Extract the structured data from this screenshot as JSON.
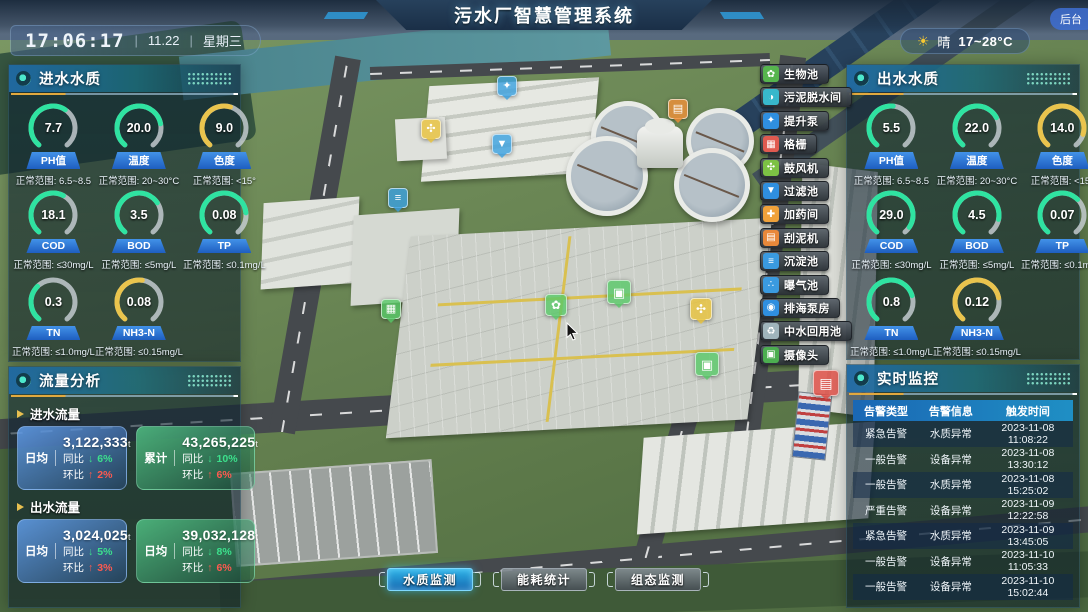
{
  "header": {
    "title": "污水厂智慧管理系统",
    "time": "17:06:17",
    "date": "11.22",
    "weekday": "星期三",
    "separator": "|",
    "weather": {
      "condition": "晴",
      "temp_range": "17~28°C"
    },
    "backstage_label": "后台"
  },
  "inlet_quality": {
    "title": "进水水质",
    "gauges": [
      {
        "label": "PH值",
        "value": "7.7",
        "range": "正常范围: 6.5~8.5",
        "color": "#2fe3a1",
        "percent": 62
      },
      {
        "label": "温度",
        "value": "20.0",
        "range": "正常范围: 20~30°C",
        "color": "#2fe3a1",
        "percent": 78
      },
      {
        "label": "色度",
        "value": "9.0",
        "range": "正常范围: <15°",
        "color": "#eac44d",
        "percent": 56
      },
      {
        "label": "COD",
        "value": "18.1",
        "range": "正常范围: ≤30mg/L",
        "color": "#2fe3a1",
        "percent": 60
      },
      {
        "label": "BOD",
        "value": "3.5",
        "range": "正常范围: ≤5mg/L",
        "color": "#2fe3a1",
        "percent": 70
      },
      {
        "label": "TP",
        "value": "0.08",
        "range": "正常范围: ≤0.1mg/L",
        "color": "#2fe3a1",
        "percent": 80
      },
      {
        "label": "TN",
        "value": "0.3",
        "range": "正常范围: ≤1.0mg/L",
        "color": "#2fe3a1",
        "percent": 34
      },
      {
        "label": "NH3-N",
        "value": "0.08",
        "range": "正常范围: ≤0.15mg/L",
        "color": "#eac44d",
        "percent": 53
      }
    ]
  },
  "outlet_quality": {
    "title": "出水水质",
    "gauges": [
      {
        "label": "PH值",
        "value": "5.5",
        "range": "正常范围: 6.5~8.5",
        "color": "#2fe3a1",
        "percent": 52
      },
      {
        "label": "温度",
        "value": "22.0",
        "range": "正常范围: 20~30°C",
        "color": "#2fe3a1",
        "percent": 72
      },
      {
        "label": "色度",
        "value": "14.0",
        "range": "正常范围: <15°",
        "color": "#eac44d",
        "percent": 88
      },
      {
        "label": "COD",
        "value": "29.0",
        "range": "正常范围: ≤30mg/L",
        "color": "#2fe3a1",
        "percent": 94
      },
      {
        "label": "BOD",
        "value": "4.5",
        "range": "正常范围: ≤5mg/L",
        "color": "#2fe3a1",
        "percent": 86
      },
      {
        "label": "TP",
        "value": "0.07",
        "range": "正常范围: ≤0.1mg/L",
        "color": "#2fe3a1",
        "percent": 66
      },
      {
        "label": "TN",
        "value": "0.8",
        "range": "正常范围: ≤1.0mg/L",
        "color": "#2fe3a1",
        "percent": 76
      },
      {
        "label": "NH3-N",
        "value": "0.12",
        "range": "正常范围: ≤0.15mg/L",
        "color": "#eac44d",
        "percent": 78
      }
    ]
  },
  "flow_analysis": {
    "title": "流量分析",
    "sections": [
      {
        "label": "进水流量",
        "cards": [
          {
            "style": "blue",
            "label": "日均",
            "value": "3,122,333",
            "unit": "t",
            "stats": [
              {
                "name": "同比",
                "dir": "down",
                "pct": "6%"
              },
              {
                "name": "环比",
                "dir": "up",
                "pct": "2%"
              }
            ]
          },
          {
            "style": "green",
            "label": "累计",
            "value": "43,265,225",
            "unit": "t",
            "stats": [
              {
                "name": "同比",
                "dir": "down",
                "pct": "10%"
              },
              {
                "name": "环比",
                "dir": "up",
                "pct": "6%"
              }
            ]
          }
        ]
      },
      {
        "label": "出水流量",
        "cards": [
          {
            "style": "blue",
            "label": "日均",
            "value": "3,024,025",
            "unit": "t",
            "stats": [
              {
                "name": "同比",
                "dir": "down",
                "pct": "5%"
              },
              {
                "name": "环比",
                "dir": "up",
                "pct": "3%"
              }
            ]
          },
          {
            "style": "green",
            "label": "日均",
            "value": "39,032,128",
            "unit": "t",
            "stats": [
              {
                "name": "同比",
                "dir": "down",
                "pct": "8%"
              },
              {
                "name": "环比",
                "dir": "up",
                "pct": "6%"
              }
            ]
          }
        ]
      }
    ]
  },
  "monitoring": {
    "title": "实时监控",
    "columns": [
      "告警类型",
      "告警信息",
      "触发时间"
    ],
    "rows": [
      [
        "紧急告警",
        "水质异常",
        "2023-11-08 11:08:22"
      ],
      [
        "一般告警",
        "设备异常",
        "2023-11-08 13:30:12"
      ],
      [
        "一般告警",
        "水质异常",
        "2023-11-08 15:25:02"
      ],
      [
        "严重告警",
        "设备异常",
        "2023-11-09 12:22:58"
      ],
      [
        "紧急告警",
        "水质异常",
        "2023-11-09 13:45:05"
      ],
      [
        "一般告警",
        "设备异常",
        "2023-11-10 11:05:33"
      ],
      [
        "一般告警",
        "设备异常",
        "2023-11-10 15:02:44"
      ]
    ]
  },
  "facility_buttons": [
    {
      "label": "生物池",
      "icon": "bio-pool-icon",
      "color": "#56b54e",
      "glyph": "✿"
    },
    {
      "label": "污泥脱水间",
      "icon": "sludge-dewatering-icon",
      "color": "#38b8cc",
      "glyph": "◑"
    },
    {
      "label": "提升泵",
      "icon": "lift-pump-icon",
      "color": "#2f8fe0",
      "glyph": "✦"
    },
    {
      "label": "格栅",
      "icon": "grid-screen-icon",
      "color": "#e05a50",
      "glyph": "▦"
    },
    {
      "label": "鼓风机",
      "icon": "blower-icon",
      "color": "#7cc144",
      "glyph": "✣"
    },
    {
      "label": "过滤池",
      "icon": "filter-pool-icon",
      "color": "#2f8fe0",
      "glyph": "▼"
    },
    {
      "label": "加药间",
      "icon": "dosing-room-icon",
      "color": "#f0a13a",
      "glyph": "✚"
    },
    {
      "label": "刮泥机",
      "icon": "mud-scraper-icon",
      "color": "#e8883a",
      "glyph": "▤"
    },
    {
      "label": "沉淀池",
      "icon": "sedimentation-pool-icon",
      "color": "#3a9ae0",
      "glyph": "≡"
    },
    {
      "label": "曝气池",
      "icon": "aeration-pool-icon",
      "color": "#3a9ae0",
      "glyph": "∴"
    },
    {
      "label": "排海泵房",
      "icon": "sea-pump-house-icon",
      "color": "#2f8fe0",
      "glyph": "◉"
    },
    {
      "label": "中水回用池",
      "icon": "water-reuse-pool-icon",
      "color": "#9fb4bc",
      "glyph": "♻"
    },
    {
      "label": "摄像头",
      "icon": "camera-icon",
      "color": "#4cae50",
      "glyph": "▣"
    }
  ],
  "bottom_tabs": [
    {
      "label": "水质监测",
      "active": true
    },
    {
      "label": "能耗统计",
      "active": false
    },
    {
      "label": "组态监测",
      "active": false
    }
  ],
  "map_markers": [
    {
      "name": "lift-pump-marker-icon",
      "x": 497,
      "y": 76,
      "color": "#3aa0e0",
      "glyph": "✦",
      "size": 20
    },
    {
      "name": "blower-marker-icon",
      "x": 421,
      "y": 119,
      "color": "#e8c23a",
      "glyph": "✣",
      "size": 20
    },
    {
      "name": "filter-pool-marker-icon",
      "x": 492,
      "y": 134,
      "color": "#3aa0e0",
      "glyph": "▼",
      "size": 20
    },
    {
      "name": "scraper-marker-icon",
      "x": 668,
      "y": 99,
      "color": "#f09038",
      "glyph": "▤",
      "size": 20
    },
    {
      "name": "sedimentation-marker-icon",
      "x": 388,
      "y": 188,
      "color": "#3aa0e0",
      "glyph": "≡",
      "size": 20
    },
    {
      "name": "grid-screen-marker-icon",
      "x": 381,
      "y": 299,
      "color": "#58c868",
      "glyph": "▦",
      "size": 20
    },
    {
      "name": "bio-pool-marker-icon",
      "x": 545,
      "y": 294,
      "color": "#58c868",
      "glyph": "✿",
      "size": 22
    },
    {
      "name": "camera-marker-icon",
      "x": 607,
      "y": 280,
      "color": "#58c868",
      "glyph": "▣",
      "size": 24
    },
    {
      "name": "blower-marker-icon-2",
      "x": 690,
      "y": 298,
      "color": "#e8c23a",
      "glyph": "✣",
      "size": 22
    },
    {
      "name": "camera-marker-icon-2",
      "x": 695,
      "y": 352,
      "color": "#58c868",
      "glyph": "▣",
      "size": 24
    },
    {
      "name": "alarm-marker-icon",
      "x": 813,
      "y": 370,
      "color": "#e04840",
      "glyph": "▤",
      "size": 26
    }
  ]
}
